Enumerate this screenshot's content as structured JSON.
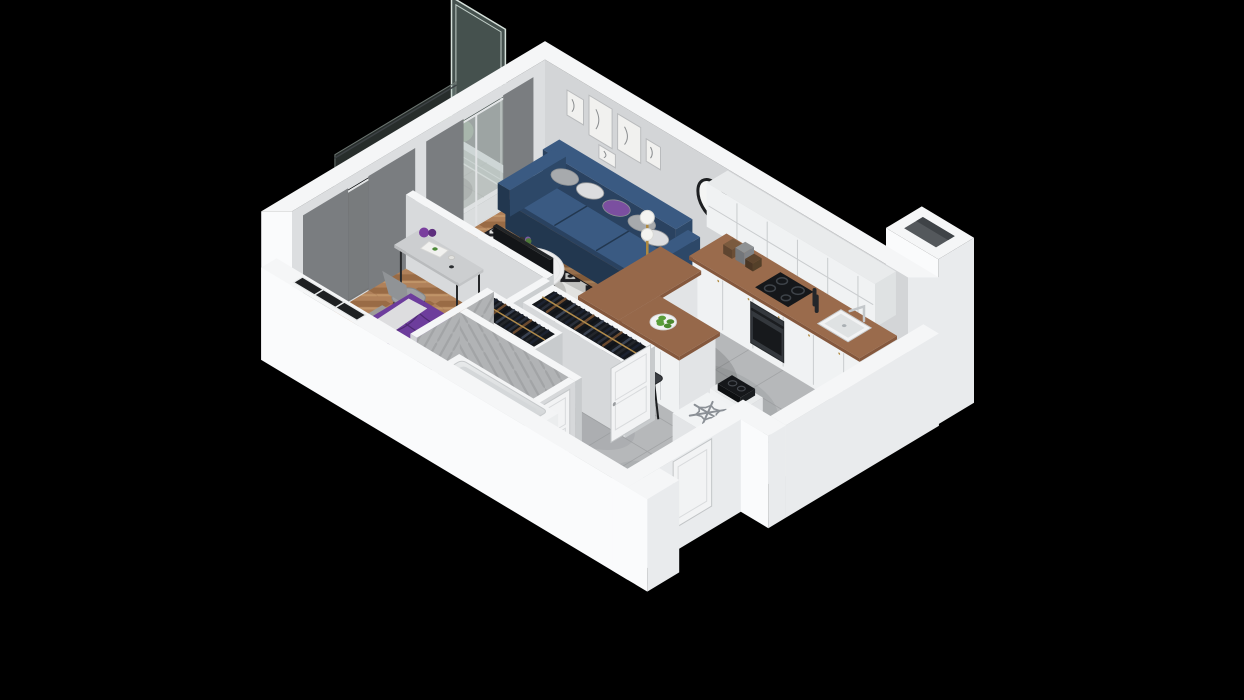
{
  "scene": {
    "title": "isometric-3d-apartment-floor-plan",
    "background": "#000000",
    "rooms": [
      {
        "name": "living-room",
        "floor": "herringbone-wood",
        "items": [
          "navy-sofa",
          "throw-cushions",
          "diamond-pattern-rug",
          "round-coffee-table",
          "flower-vase",
          "floor-lamp",
          "wall-clock",
          "gallery-picture-frames",
          "tv-panel",
          "window-curtains"
        ]
      },
      {
        "name": "kitchen",
        "floor": "gray-tile",
        "items": [
          "upper-cabinets",
          "base-cabinets",
          "wood-countertop",
          "cooktop",
          "oven",
          "sink",
          "l-shaped-bar-island",
          "bar-stools",
          "fruit-bowl-green-apples",
          "fridge-space-with-snowflake-mark",
          "vent-shaft"
        ]
      },
      {
        "name": "bedroom",
        "floor": "herringbone-wood",
        "items": [
          "double-bed-purple-duvet",
          "white-pillows",
          "bed-rug",
          "desk",
          "desk-chair",
          "purple-vases",
          "window-curtains"
        ]
      },
      {
        "name": "hallway",
        "floor": "gray-tile",
        "items": [
          "wardrobe-rack-hall",
          "wardrobe-rack-bedroom",
          "open-white-door",
          "entry-door"
        ]
      },
      {
        "name": "bathroom",
        "floor": "gray-tile",
        "items": [
          "bathtub",
          "herringbone-tiled-walls",
          "bathroom-door"
        ]
      },
      {
        "name": "loggia",
        "floor": "tile",
        "items": [
          "frosted-glass-divider",
          "green-plant",
          "glass-balustrade"
        ]
      }
    ],
    "icons": [
      "snowflake-icon"
    ],
    "colors": {
      "bg": "#000000",
      "wall_cap": "#f5f6f7",
      "wall_outer": "#fafbfc",
      "wall_outer_side": "#e9ebed",
      "wall_in_nw": "#dcdee0",
      "wall_in_ne": "#d3d5d7",
      "wood": "#b0815a",
      "wood_dark": "#996b45",
      "wood_light": "#c09468",
      "tile": "#b6b8ba",
      "tile_bath": "#b1b3b5",
      "grout": "#a2a4a6",
      "rug_bg": "#e2e2e0",
      "rug_dark": "#232327",
      "sofa": "#2d4868",
      "sofa_top": "#3a5a82",
      "sofa_mid": "#2a4260",
      "sofa_dark": "#22374f",
      "pillow_gray": "#a7aaad",
      "pillow_white": "#dcdddf",
      "pillow_purple": "#7b4fa0",
      "table_white": "#ededee",
      "lamp_gold": "#b08a3f",
      "counter": "#85583d",
      "counter_top": "#9a6b4c",
      "island_top": "#96684a",
      "cab_white": "#e9ebec",
      "cab_face": "#f0f2f3",
      "cab_line": "#c9ccce",
      "cook_black": "#15171a",
      "steel": "#34383d",
      "apple": "#5a9e3a",
      "stool": "#3a3d42",
      "fridge": "#f1f3f4",
      "snow": "#8b9096",
      "bed_purple": "#63368f",
      "bed_purple_top": "#6d3d9c",
      "bed_frame": "#c9a37f",
      "bed_rug": "#9c9c9a",
      "sheet": "#dddddf",
      "desk": "#ccced0",
      "chairc": "#9ea1a4",
      "legs": "#26282a",
      "mirror1": "#2e3440",
      "mirror2": "#59616d",
      "vase": "#7a3f9e",
      "clothes": [
        "#1c2230",
        "#2a2f3a",
        "#6b4a2f",
        "#101318",
        "#394150",
        "#23262b"
      ],
      "rod": "#b08a4a",
      "rack_in": "#15181d",
      "tub_in": "#d7dadc",
      "glass": "#9ab4ac",
      "curt1": "#8e9194",
      "curt2": "#7a7d80",
      "curt3": "#a0a3a6",
      "sheer": "#d8dadc",
      "plant": "#4e7a3a",
      "plant_dark": "#3a5c2b",
      "pot": "#3c3f42",
      "black_glass": "#0a0c0e",
      "door_white": "#f2f3f4",
      "clock": "#1d1f21",
      "frame_line": "#8a8d8f",
      "paper": "#f1f1ef"
    }
  }
}
